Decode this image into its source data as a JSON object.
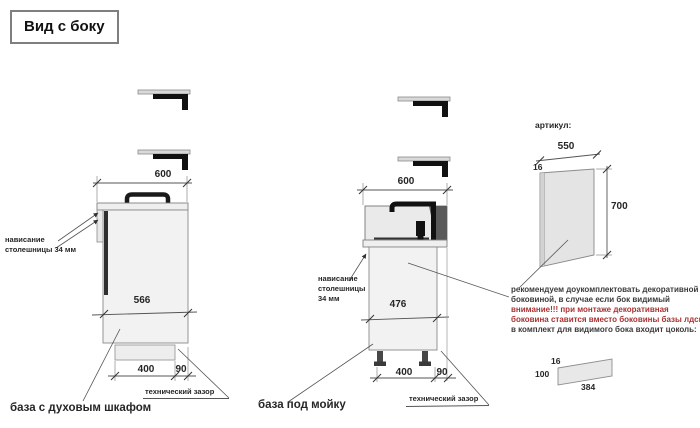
{
  "title": "Вид с боку",
  "colors": {
    "warning_red": "#a83232",
    "text": "#262626",
    "line": "#5a5a5a"
  },
  "left_cabinet": {
    "label": "база с духовым шкафом",
    "top_width": "600",
    "inner_depth": "566",
    "plinth_depth": "400",
    "tech_gap_width": "90",
    "overhang_line1": "нависание",
    "overhang_line2": "столешницы 34 мм",
    "tech_gap_label": "технический зазор"
  },
  "sink_cabinet": {
    "label": "база под мойку",
    "top_width": "600",
    "inner_depth": "476",
    "plinth_depth": "400",
    "tech_gap_width": "90",
    "overhang_line1": "нависание",
    "overhang_line2": "столешницы",
    "overhang_line3": "34 мм",
    "tech_gap_label": "технический зазор"
  },
  "decor_panel": {
    "heading": "артикул:",
    "width": "550",
    "thickness": "16",
    "height": "700",
    "note": [
      "рекомендуем доукомплектовать декоративной",
      "боковиной, в случае если бок видимый",
      "внимание!!! при монтаже декоративная",
      "боковина ставится вместо боковины базы лдсп",
      "в комплект для видимого бока входит цоколь:"
    ],
    "plinth_thickness": "16",
    "plinth_height": "100",
    "plinth_length": "384"
  }
}
